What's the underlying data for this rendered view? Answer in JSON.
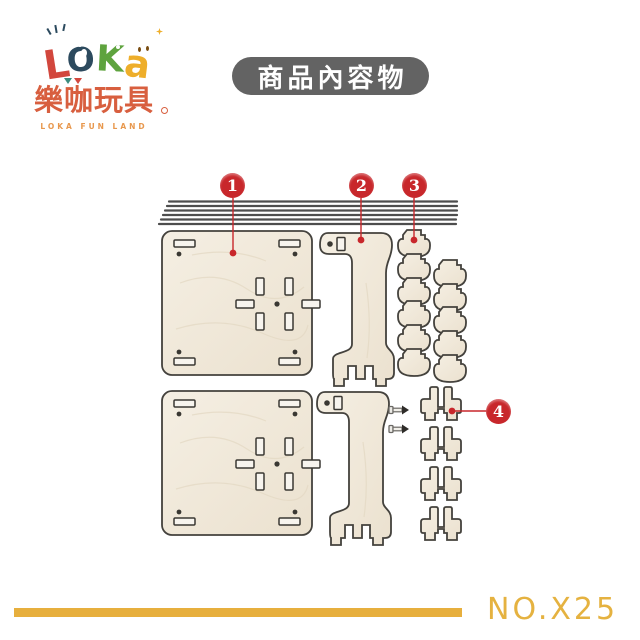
{
  "brand": {
    "logo_letters": [
      {
        "char": "L",
        "color": "#d2473d"
      },
      {
        "char": "O",
        "color": "#2c4a5e"
      },
      {
        "char": "K",
        "color": "#5ea33e"
      },
      {
        "char": "a",
        "color": "#eeae2a"
      }
    ],
    "name_zh": "樂咖玩具",
    "name_en": "LOKA FUN LAND"
  },
  "header": {
    "title": "商品內容物"
  },
  "diagram": {
    "markers": [
      {
        "num": "1",
        "part": "square-panel",
        "count": 2
      },
      {
        "num": "2",
        "part": "support-arm",
        "count": 2
      },
      {
        "num": "3",
        "part": "round-tab-piece",
        "count": 11
      },
      {
        "num": "4",
        "part": "pronged-connector",
        "count": 4
      }
    ],
    "rod_count": 6,
    "screw_count": 2
  },
  "footer": {
    "model_no": "NO.X25"
  },
  "colors": {
    "marker_red": "#c8272b",
    "header_bg": "#636363",
    "gold_accent": "#e7af3d",
    "wood_fill": "#f1e9da",
    "wood_outline": "#44423d",
    "brand_red": "#d85f3f"
  }
}
